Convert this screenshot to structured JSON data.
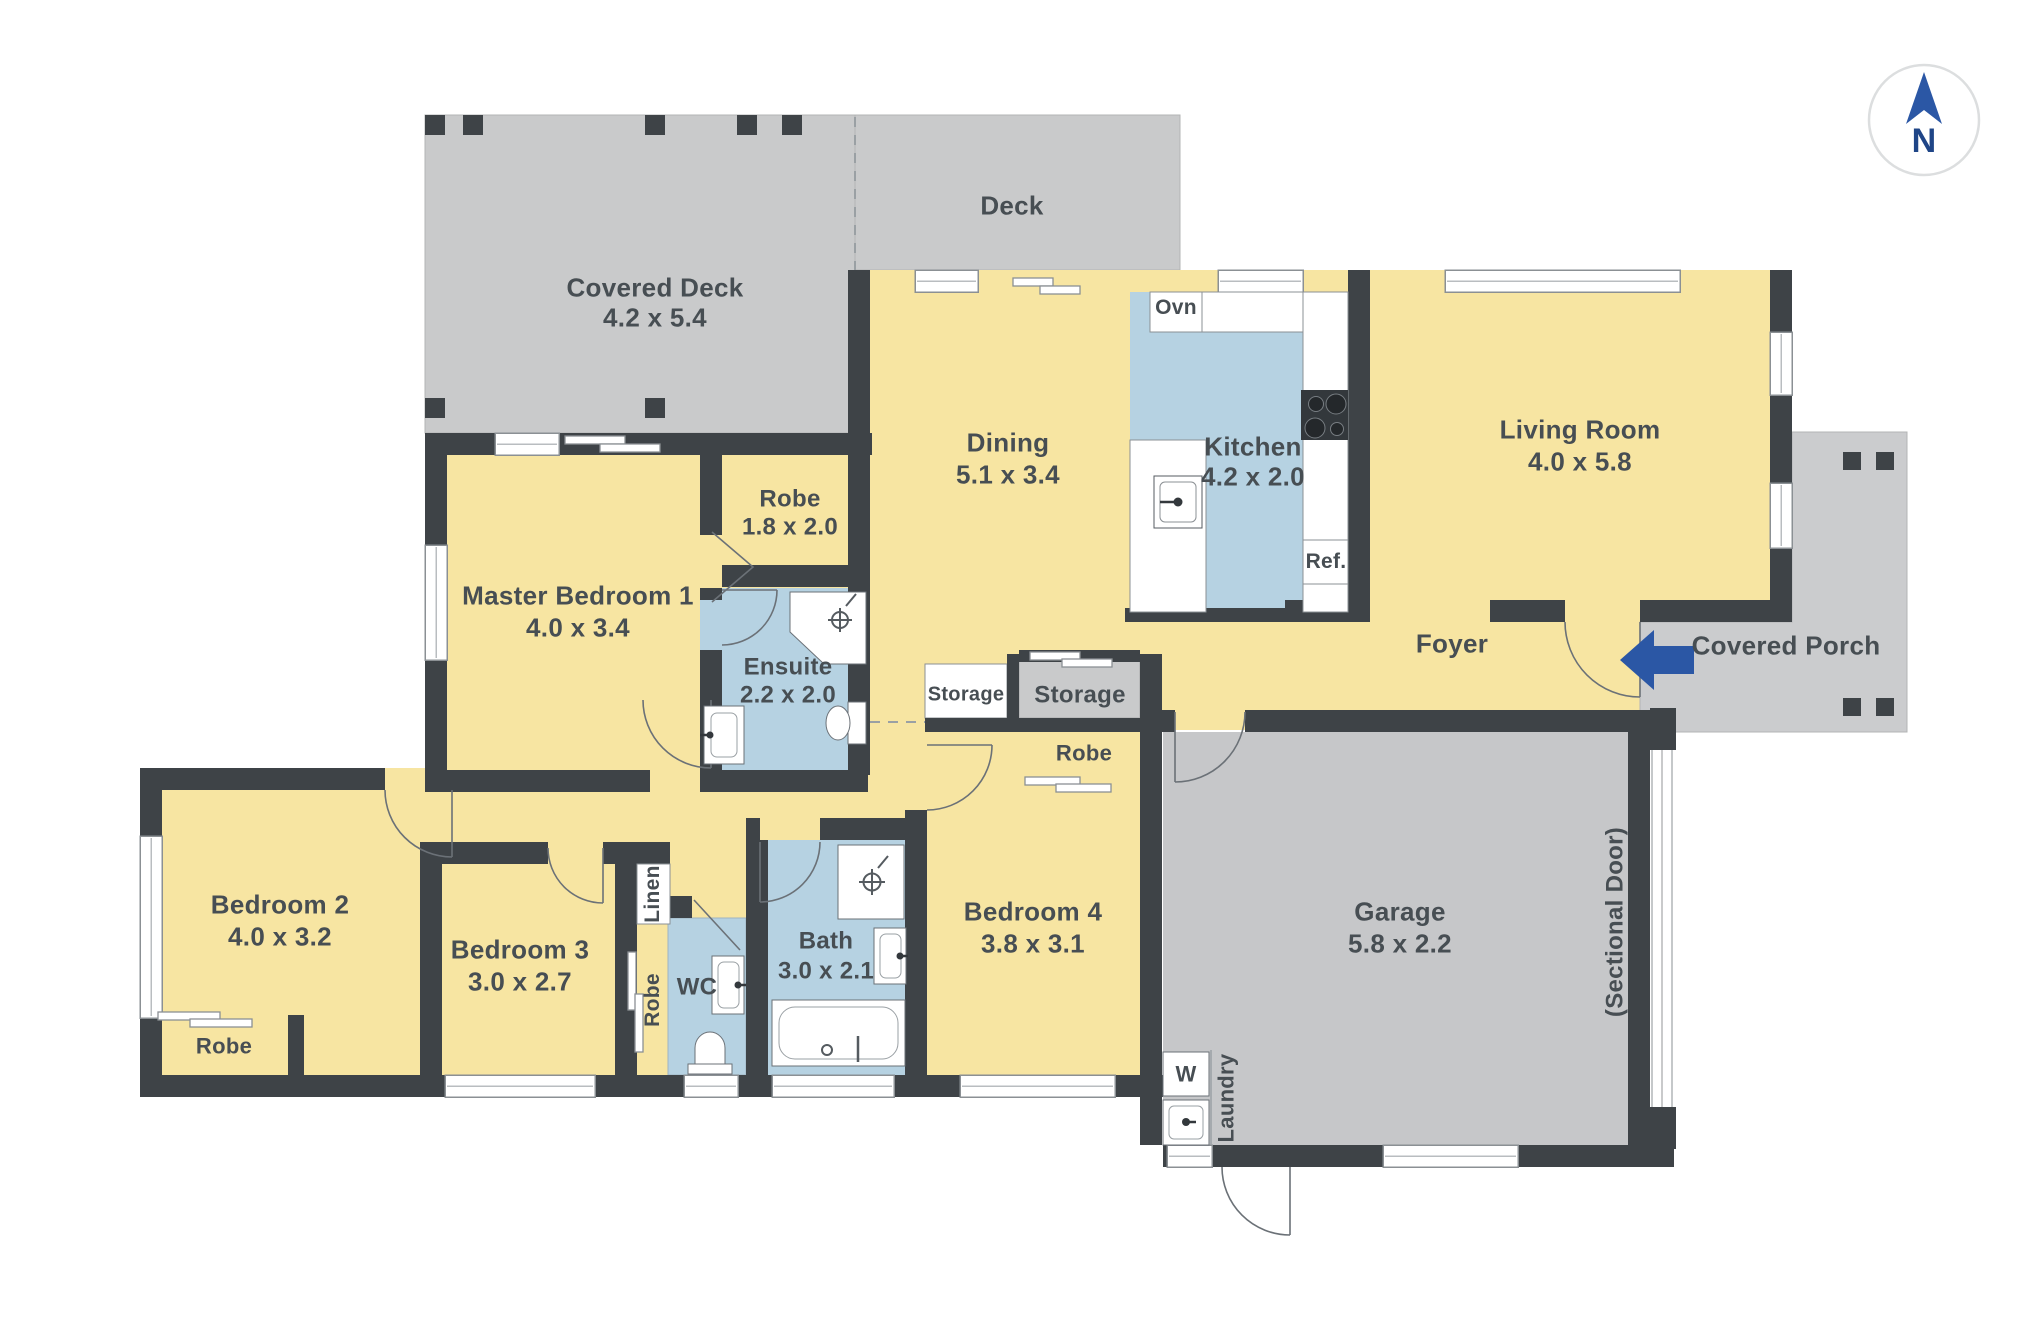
{
  "compass": {
    "label": "N"
  },
  "rooms": [
    {
      "id": "covered-deck",
      "name": "Covered Deck",
      "dims": "4.2 x 5.4"
    },
    {
      "id": "deck",
      "name": "Deck",
      "dims": ""
    },
    {
      "id": "master-bedroom",
      "name": "Master Bedroom 1",
      "dims": "4.0 x 3.4"
    },
    {
      "id": "robe-master",
      "name": "Robe",
      "dims": "1.8 x 2.0"
    },
    {
      "id": "ensuite",
      "name": "Ensuite",
      "dims": "2.2 x 2.0"
    },
    {
      "id": "dining",
      "name": "Dining",
      "dims": "5.1 x 3.4"
    },
    {
      "id": "kitchen",
      "name": "Kitchen",
      "dims": "4.2 x 2.0"
    },
    {
      "id": "living-room",
      "name": "Living Room",
      "dims": "4.0 x 5.8"
    },
    {
      "id": "foyer",
      "name": "Foyer",
      "dims": ""
    },
    {
      "id": "covered-porch",
      "name": "Covered Porch",
      "dims": ""
    },
    {
      "id": "garage",
      "name": "Garage",
      "dims": "5.8 x 2.2"
    },
    {
      "id": "bedroom-2",
      "name": "Bedroom 2",
      "dims": "4.0 x 3.2"
    },
    {
      "id": "bedroom-3",
      "name": "Bedroom 3",
      "dims": "3.0 x 2.7"
    },
    {
      "id": "bedroom-4",
      "name": "Bedroom 4",
      "dims": "3.8 x 3.1"
    },
    {
      "id": "bath",
      "name": "Bath",
      "dims": "3.0 x 2.1"
    }
  ],
  "labels": {
    "storage_small": "Storage",
    "storage_large": "Storage",
    "robe_bed4": "Robe",
    "robe_bed2": "Robe",
    "robe_bed3": "Robe",
    "linen": "Linen",
    "wc": "WC",
    "laundry": "Laundry",
    "washer": "W",
    "oven": "Ovn",
    "fridge": "Ref.",
    "sectional_door": "(Sectional Door)"
  },
  "colors": {
    "wall": "#3E4347",
    "room_yellow": "#F7E5A2",
    "wet_blue": "#B6D2E2",
    "deck_gray": "#C9CACB",
    "accent_blue": "#2B57A5"
  }
}
